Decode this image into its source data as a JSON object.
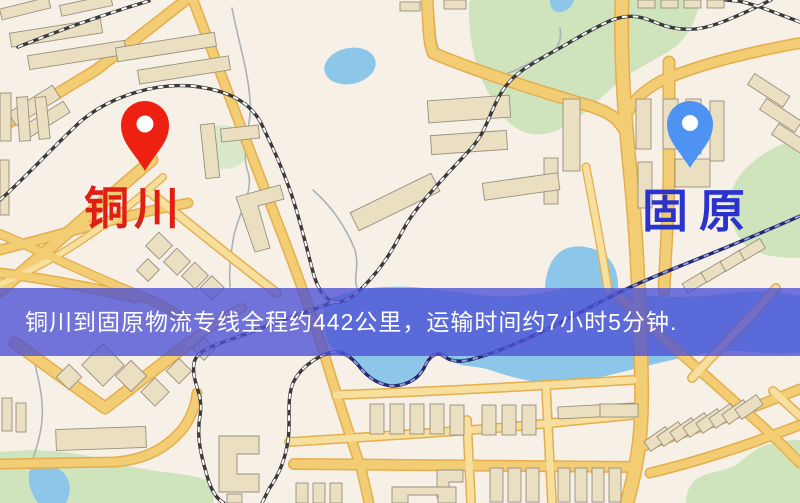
{
  "banner": {
    "text": "铜川到固原物流专线全程约442公里，运输时间约7小时5分钟."
  },
  "markers": {
    "origin": {
      "label": "铜川",
      "pin_color": "#ee2011",
      "label_color": "#e01f14"
    },
    "destination": {
      "label": "固原",
      "pin_color": "#4f93f2",
      "label_color": "#2a33cc"
    }
  },
  "route_info": {
    "origin": "铜川",
    "destination": "固原",
    "distance_text": "约442公里",
    "duration_text": "约7小时5分钟"
  },
  "colors": {
    "banner_bg": "#4c50d4",
    "banner_text": "#ffffff",
    "map_background": "#f7f0e7",
    "road_main": "#f3cd74",
    "road_casing": "#e4ae4e",
    "water": "#8cc6e9",
    "green_area": "#cfe3bd",
    "building": "#ebdfc2",
    "railway": "#3a3a3a"
  }
}
